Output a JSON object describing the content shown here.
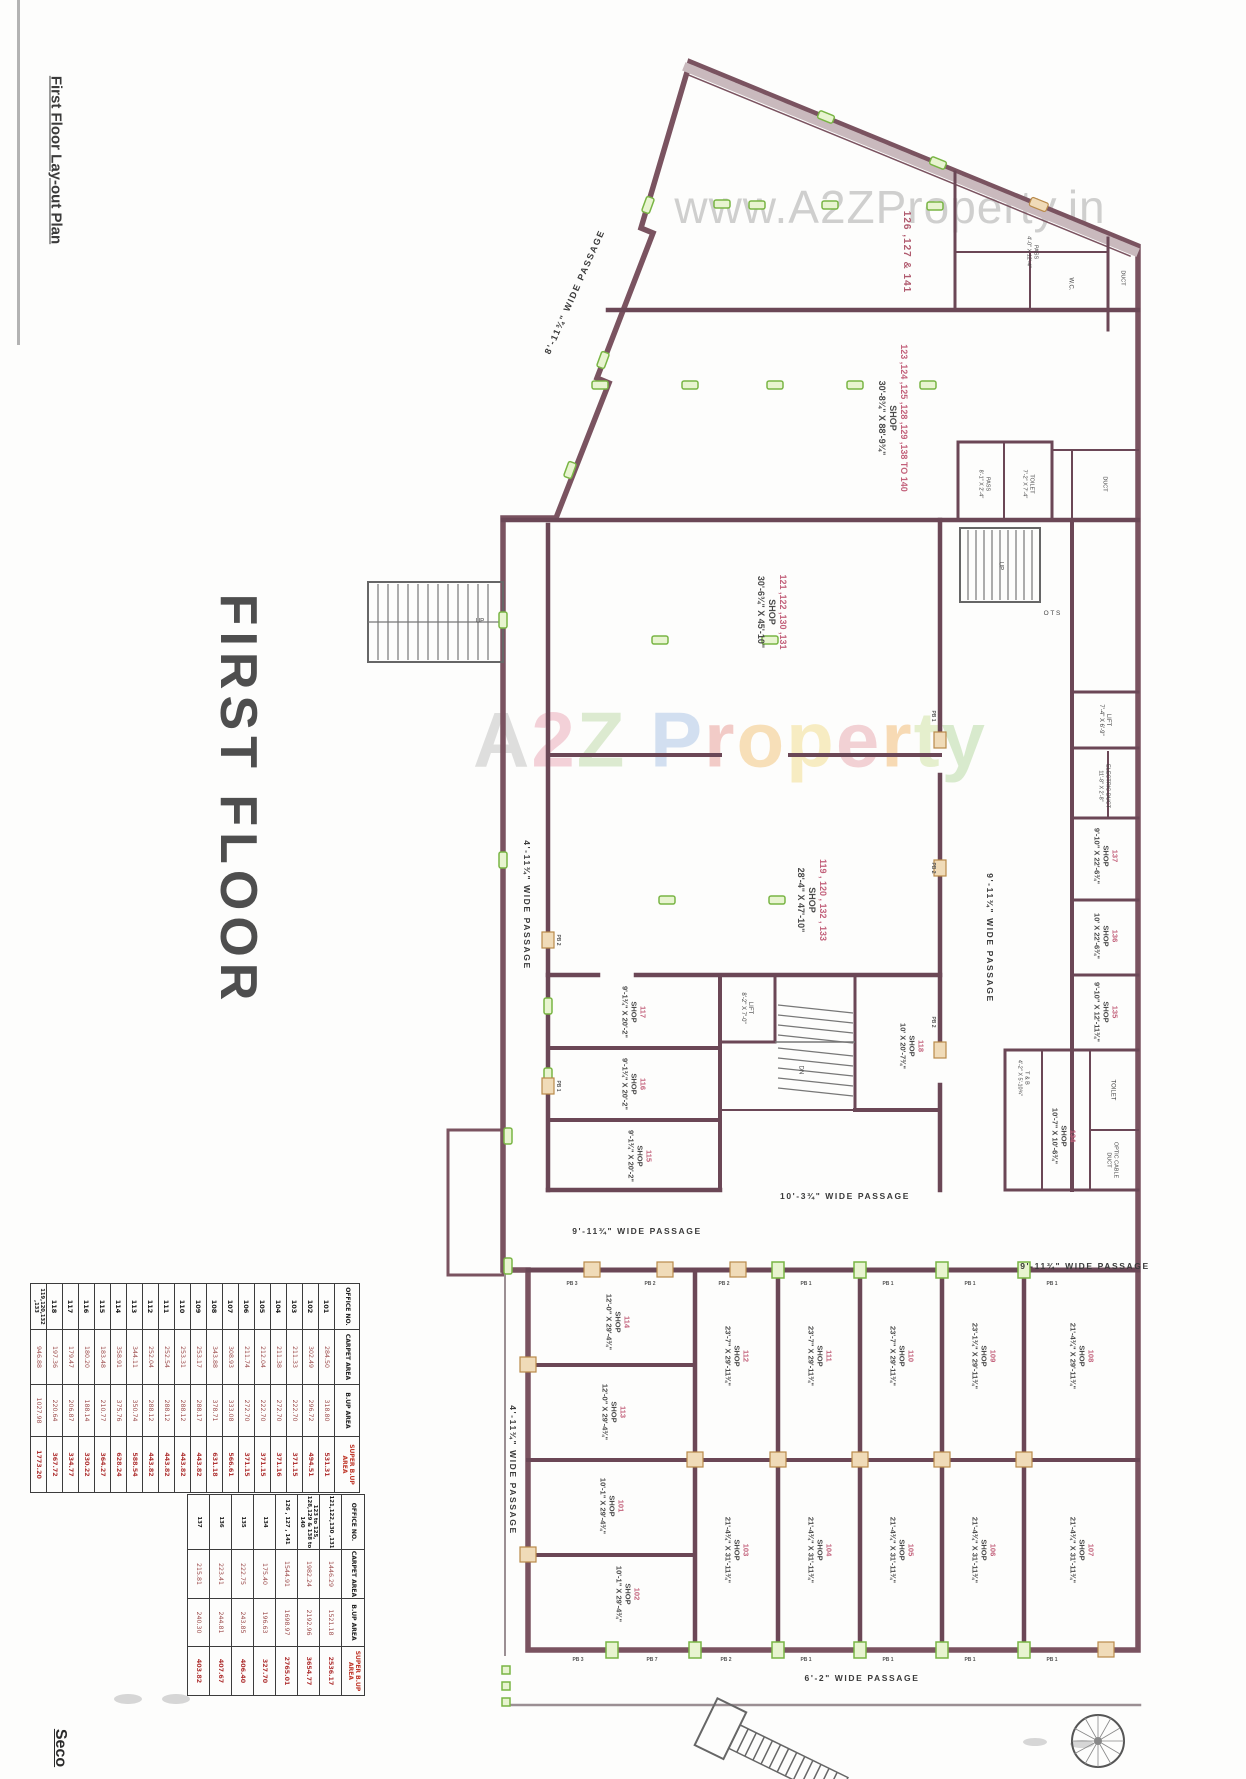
{
  "page": {
    "sheet_title": "First Floor Lay-out Plan",
    "floor_title": "FIRST FLOOR",
    "next_sheet_partial": "Seco",
    "watermark_top": "www.A2ZProperty.in",
    "watermark_center_letters": [
      {
        "ch": "A",
        "color": "#c0c0c0"
      },
      {
        "ch": "2",
        "color": "#eaa6b5"
      },
      {
        "ch": "Z",
        "color": "#bcd9a6"
      },
      {
        "ch": " ",
        "color": "#c0c0c0"
      },
      {
        "ch": "P",
        "color": "#a9c3e6"
      },
      {
        "ch": "r",
        "color": "#e99a93"
      },
      {
        "ch": "o",
        "color": "#f2c277"
      },
      {
        "ch": "p",
        "color": "#f2dd8a"
      },
      {
        "ch": "e",
        "color": "#e9a6ae"
      },
      {
        "ch": "r",
        "color": "#f2b96f"
      },
      {
        "ch": "t",
        "color": "#cfe3a0"
      },
      {
        "ch": "y",
        "color": "#b5d9a0"
      }
    ]
  },
  "colors": {
    "outer_wall": "#7a5360",
    "partition": "#6b4756",
    "marker_green": "#79b544",
    "marker_tan": "#b98a4a",
    "room_number": "#c2607a",
    "table_red": "#c0392b"
  },
  "tables": {
    "headers": [
      "OFFICE NO.",
      "CARPET AREA",
      "B.UP AREA",
      "SUPER B.UP AREA"
    ],
    "first": [
      {
        "no": "101",
        "carpet": "284.50",
        "bup": "318.80",
        "super": "531.31"
      },
      {
        "no": "102",
        "carpet": "302.49",
        "bup": "296.72",
        "super": "494.51"
      },
      {
        "no": "103",
        "carpet": "211.33",
        "bup": "222.70",
        "super": "371.15"
      },
      {
        "no": "104",
        "carpet": "211.38",
        "bup": "272.70",
        "super": "371.16"
      },
      {
        "no": "105",
        "carpet": "212.04",
        "bup": "222.70",
        "super": "371.15"
      },
      {
        "no": "106",
        "carpet": "211.74",
        "bup": "272.70",
        "super": "371.15"
      },
      {
        "no": "107",
        "carpet": "308.93",
        "bup": "333.08",
        "super": "566.61"
      },
      {
        "no": "108",
        "carpet": "343.88",
        "bup": "378.71",
        "super": "631.18"
      },
      {
        "no": "109",
        "carpet": "253.17",
        "bup": "288.17",
        "super": "443.82"
      },
      {
        "no": "110",
        "carpet": "253.31",
        "bup": "288.12",
        "super": "443.82"
      },
      {
        "no": "111",
        "carpet": "252.54",
        "bup": "288.12",
        "super": "443.82"
      },
      {
        "no": "112",
        "carpet": "252.04",
        "bup": "288.12",
        "super": "443.82"
      },
      {
        "no": "113",
        "carpet": "344.11",
        "bup": "350.74",
        "super": "588.54"
      },
      {
        "no": "114",
        "carpet": "358.91",
        "bup": "375.76",
        "super": "628.24"
      },
      {
        "no": "115",
        "carpet": "183.48",
        "bup": "210.77",
        "super": "364.27"
      },
      {
        "no": "116",
        "carpet": "180.20",
        "bup": "188.14",
        "super": "330.22"
      },
      {
        "no": "117",
        "carpet": "179.47",
        "bup": "206.87",
        "super": "334.77"
      },
      {
        "no": "118",
        "carpet": "197.36",
        "bup": "220.64",
        "super": "367.72"
      },
      {
        "no": "119,120,132 ,133",
        "carpet": "946.88",
        "bup": "1027.98",
        "super": "1773.20"
      }
    ],
    "second": [
      {
        "no": "121,122,130 ,131",
        "carpet": "1446.29",
        "bup": "1521.18",
        "super": "2536.17"
      },
      {
        "no": "123 to 125, 128,129 & 138 to 140",
        "carpet": "1982.24",
        "bup": "2192.96",
        "super": "3654.77"
      },
      {
        "no": "126 , 127 , 141",
        "carpet": "1544.91",
        "bup": "1698.97",
        "super": "2765.01"
      },
      {
        "no": "134",
        "carpet": "175.40",
        "bup": "196.63",
        "super": "327.70"
      },
      {
        "no": "135",
        "carpet": "222.75",
        "bup": "243.85",
        "super": "406.40"
      },
      {
        "no": "136",
        "carpet": "223.41",
        "bup": "244.81",
        "super": "407.67"
      },
      {
        "no": "137",
        "carpet": "215.81",
        "bup": "240.30",
        "super": "403.82"
      }
    ]
  },
  "plan": {
    "labels": [
      {
        "name": "room-126-127-141",
        "text": "126 ,127 & 141",
        "x": 906,
        "y": 252,
        "rot": 90,
        "size": 10,
        "cls": "plan-label grp-label"
      },
      {
        "name": "room-123-to-140",
        "text": "123 ,124 ,125 ,128 ,129 ,138 TO 140\nSHOP\n30'-8¾\" X 88'-9¾\"",
        "x": 893,
        "y": 418,
        "rot": 90,
        "size": 9,
        "cls": "plan-label room-label"
      },
      {
        "name": "room-121-122-130-131",
        "text": "121 ,122 ,130 ,131\nSHOP\n30'-6¾\" X 45'-10\"",
        "x": 772,
        "y": 612,
        "rot": 90,
        "size": 9,
        "cls": "plan-label room-label"
      },
      {
        "name": "room-119-120-132-133",
        "text": "119 , 120 , 132 , 133\nSHOP\n28'-4\" X 47'-10\"",
        "x": 812,
        "y": 900,
        "rot": 90,
        "size": 9,
        "cls": "plan-label room-label"
      },
      {
        "name": "room-118",
        "text": "118\nSHOP\n10' X 20'-7¾\"",
        "x": 912,
        "y": 1046,
        "rot": 90,
        "size": 7.5,
        "cls": "plan-label room-label"
      },
      {
        "name": "room-117",
        "text": "117\nSHOP\n9'-1¾\" X 20'-2\"",
        "x": 634,
        "y": 1012,
        "rot": 90,
        "size": 7.5,
        "cls": "plan-label room-label"
      },
      {
        "name": "room-116",
        "text": "116\nSHOP\n9'-1¾\" X 20'-2\"",
        "x": 634,
        "y": 1084,
        "rot": 90,
        "size": 7.5,
        "cls": "plan-label room-label"
      },
      {
        "name": "room-115",
        "text": "115\nSHOP\n9'-1¾\" X 20'-2\"",
        "x": 640,
        "y": 1156,
        "rot": 90,
        "size": 7.5,
        "cls": "plan-label room-label"
      },
      {
        "name": "room-137",
        "text": "137\nSHOP\n9'-10\" X 22'-6¾\"",
        "x": 1106,
        "y": 856,
        "rot": 90,
        "size": 7.5,
        "cls": "plan-label room-label"
      },
      {
        "name": "room-136",
        "text": "136\nSHOP\n10' X 22'-6¾\"",
        "x": 1106,
        "y": 936,
        "rot": 90,
        "size": 7.5,
        "cls": "plan-label room-label"
      },
      {
        "name": "room-135",
        "text": "135\nSHOP\n9'-10\" X 12'-11¾\"",
        "x": 1106,
        "y": 1012,
        "rot": 90,
        "size": 7.5,
        "cls": "plan-label room-label"
      },
      {
        "name": "room-134",
        "text": "134\nSHOP\n10'-7\" X 10'-6¾\"",
        "x": 1064,
        "y": 1136,
        "rot": 90,
        "size": 7.5,
        "cls": "plan-label room-label"
      },
      {
        "name": "lift-right-label",
        "text": "LIFT\n7'-4\" X 6'-9\"",
        "x": 1104,
        "y": 720,
        "rot": 90,
        "size": 6,
        "cls": "plan-label small-label"
      },
      {
        "name": "electric-duct-label",
        "text": "ELECTRIC DUCT\n11'-8\" X 2'-8\"",
        "x": 1104,
        "y": 786,
        "rot": 90,
        "size": 5.5,
        "cls": "plan-label small-label"
      },
      {
        "name": "lift-mid-label",
        "text": "LIFT\n8'-2\" X 7'-0\"",
        "x": 746,
        "y": 1008,
        "rot": 90,
        "size": 6,
        "cls": "plan-label small-label"
      },
      {
        "name": "toilet-right-label",
        "text": "TOILET",
        "x": 1112,
        "y": 1090,
        "rot": 90,
        "size": 6,
        "cls": "plan-label small-label"
      },
      {
        "name": "t-and-b-label",
        "text": "T & B\n4'-2\" X 5'-10¾\"",
        "x": 1023,
        "y": 1078,
        "rot": 90,
        "size": 5.5,
        "cls": "plan-label small-label"
      },
      {
        "name": "optic-cable-duct-label",
        "text": "OPTIC CABLE\nDUCT",
        "x": 1112,
        "y": 1160,
        "rot": 90,
        "size": 5.5,
        "cls": "plan-label small-label"
      },
      {
        "name": "ots-label",
        "text": "O T S",
        "x": 1052,
        "y": 614,
        "rot": 0,
        "size": 6.5,
        "cls": "plan-label small-label"
      },
      {
        "name": "up-stair-right-label",
        "text": "UP",
        "x": 1000,
        "y": 566,
        "rot": 90,
        "size": 6,
        "cls": "plan-label small-label"
      },
      {
        "name": "dn-stair-mid-label",
        "text": "DN",
        "x": 800,
        "y": 1070,
        "rot": 90,
        "size": 6,
        "cls": "plan-label small-label"
      },
      {
        "name": "up-stair-left-label",
        "text": "UP",
        "x": 480,
        "y": 622,
        "rot": 0,
        "size": 6,
        "cls": "plan-label small-label"
      },
      {
        "name": "pass-top-label",
        "text": "PASS\n4'-0\" X 12'-4\"",
        "x": 1032,
        "y": 252,
        "rot": 90,
        "size": 5.5,
        "cls": "plan-label small-label"
      },
      {
        "name": "wc-top-label",
        "text": "W.C.",
        "x": 1070,
        "y": 284,
        "rot": 90,
        "size": 6,
        "cls": "plan-label small-label"
      },
      {
        "name": "duct-top-label",
        "text": "DUCT",
        "x": 1122,
        "y": 278,
        "rot": 90,
        "size": 5.5,
        "cls": "plan-label small-label"
      },
      {
        "name": "pass-mid-label",
        "text": "PASS\n8'-1\" X 2'-4\"",
        "x": 984,
        "y": 484,
        "rot": 90,
        "size": 5.5,
        "cls": "plan-label small-label"
      },
      {
        "name": "toilet-mid-label",
        "text": "TOILET\n7'-2\" X 7'-4\"",
        "x": 1028,
        "y": 484,
        "rot": 90,
        "size": 5.5,
        "cls": "plan-label small-label"
      },
      {
        "name": "duct-mid-label",
        "text": "DUCT",
        "x": 1104,
        "y": 484,
        "rot": 90,
        "size": 5.5,
        "cls": "plan-label small-label"
      },
      {
        "name": "passage-diagonal-label",
        "text": "8'-11¾\" WIDE PASSAGE",
        "x": 575,
        "y": 292,
        "rot": -66,
        "size": 9,
        "cls": "plan-label passage-label"
      },
      {
        "name": "passage-left-upper-label",
        "text": "4'-11¾\" WIDE PASSAGE",
        "x": 527,
        "y": 905,
        "rot": 90,
        "size": 8.5,
        "cls": "plan-label passage-label"
      },
      {
        "name": "passage-left-lower-label",
        "text": "4'-11¾\" WIDE PASSAGE",
        "x": 513,
        "y": 1470,
        "rot": 90,
        "size": 8.5,
        "cls": "plan-label passage-label"
      },
      {
        "name": "passage-mid-vertical-label",
        "text": "9'-11¾\" WIDE PASSAGE",
        "x": 990,
        "y": 938,
        "rot": 90,
        "size": 8.5,
        "cls": "plan-label passage-label"
      },
      {
        "name": "passage-h-left-label",
        "text": "9'-11¾\" WIDE PASSAGE",
        "x": 637,
        "y": 1231,
        "rot": 0,
        "size": 8.5,
        "cls": "plan-label passage-label"
      },
      {
        "name": "passage-h-mid-label",
        "text": "10'-3¾\" WIDE PASSAGE",
        "x": 845,
        "y": 1196,
        "rot": 0,
        "size": 8.5,
        "cls": "plan-label passage-label"
      },
      {
        "name": "passage-h-right-label",
        "text": "9'-11¾\" WIDE PASSAGE",
        "x": 1085,
        "y": 1266,
        "rot": 0,
        "size": 8.5,
        "cls": "plan-label passage-label"
      },
      {
        "name": "passage-h-bottom-label",
        "text": "6'-2\" WIDE PASSAGE",
        "x": 862,
        "y": 1678,
        "rot": 0,
        "size": 8.5,
        "cls": "plan-label passage-label"
      },
      {
        "name": "room-114",
        "text": "114\nSHOP\n12'-0\" X 29'-4¾\"",
        "x": 618,
        "y": 1322,
        "rot": 90,
        "size": 7.5,
        "cls": "plan-label room-label"
      },
      {
        "name": "room-113",
        "text": "113\nSHOP\n12'-0\" X 29'-4¾\"",
        "x": 614,
        "y": 1412,
        "rot": 90,
        "size": 7.5,
        "cls": "plan-label room-label"
      },
      {
        "name": "room-101",
        "text": "101\nSHOP\n10'-1\" X 29'-4¾\"",
        "x": 612,
        "y": 1506,
        "rot": 90,
        "size": 7.5,
        "cls": "plan-label room-label"
      },
      {
        "name": "room-102",
        "text": "102\nSHOP\n10'-1\" X 29'-4¾\"",
        "x": 628,
        "y": 1594,
        "rot": 90,
        "size": 7.5,
        "cls": "plan-label room-label"
      },
      {
        "name": "room-112",
        "text": "112\nSHOP\n23'-7\" X 29'-11¾\"",
        "x": 737,
        "y": 1356,
        "rot": 90,
        "size": 7.5,
        "cls": "plan-label room-label"
      },
      {
        "name": "room-111",
        "text": "111\nSHOP\n23'-7\" X 29'-11¾\"",
        "x": 820,
        "y": 1356,
        "rot": 90,
        "size": 7.5,
        "cls": "plan-label room-label"
      },
      {
        "name": "room-110",
        "text": "110\nSHOP\n23'-7\" X 29'-11¾\"",
        "x": 902,
        "y": 1356,
        "rot": 90,
        "size": 7.5,
        "cls": "plan-label room-label"
      },
      {
        "name": "room-109",
        "text": "109\nSHOP\n23'-1¾\" X 29'-11¾\"",
        "x": 984,
        "y": 1356,
        "rot": 90,
        "size": 7.5,
        "cls": "plan-label room-label"
      },
      {
        "name": "room-108",
        "text": "108\nSHOP\n21'-4¾\" X 29'-11¾\"",
        "x": 1082,
        "y": 1356,
        "rot": 90,
        "size": 7.5,
        "cls": "plan-label room-label"
      },
      {
        "name": "room-103",
        "text": "103\nSHOP\n21'-4¾\" X 31'-11¾\"",
        "x": 737,
        "y": 1550,
        "rot": 90,
        "size": 7.5,
        "cls": "plan-label room-label"
      },
      {
        "name": "room-104",
        "text": "104\nSHOP\n21'-4¾\" X 31'-11¾\"",
        "x": 820,
        "y": 1550,
        "rot": 90,
        "size": 7.5,
        "cls": "plan-label room-label"
      },
      {
        "name": "room-105",
        "text": "105\nSHOP\n21'-4¾\" X 31'-11¾\"",
        "x": 902,
        "y": 1550,
        "rot": 90,
        "size": 7.5,
        "cls": "plan-label room-label"
      },
      {
        "name": "room-106",
        "text": "106\nSHOP\n21'-4¾\" X 31'-11¾\"",
        "x": 984,
        "y": 1550,
        "rot": 90,
        "size": 7.5,
        "cls": "plan-label room-label"
      },
      {
        "name": "room-107",
        "text": "107\nSHOP\n21'-4¾\" X 31'-11¾\"",
        "x": 1082,
        "y": 1550,
        "rot": 90,
        "size": 7.5,
        "cls": "plan-label room-label"
      },
      {
        "name": "pier-label",
        "text": "PB 3",
        "x": 572,
        "y": 1284,
        "rot": 0,
        "size": 5,
        "cls": "plan-label tiny"
      },
      {
        "name": "pier-label",
        "text": "PB 2",
        "x": 650,
        "y": 1284,
        "rot": 0,
        "size": 5,
        "cls": "plan-label tiny"
      },
      {
        "name": "pier-label",
        "text": "PB 2",
        "x": 724,
        "y": 1284,
        "rot": 0,
        "size": 5,
        "cls": "plan-label tiny"
      },
      {
        "name": "pier-label",
        "text": "PB 1",
        "x": 806,
        "y": 1284,
        "rot": 0,
        "size": 5,
        "cls": "plan-label tiny"
      },
      {
        "name": "pier-label",
        "text": "PB 1",
        "x": 888,
        "y": 1284,
        "rot": 0,
        "size": 5,
        "cls": "plan-label tiny"
      },
      {
        "name": "pier-label",
        "text": "PB 1",
        "x": 970,
        "y": 1284,
        "rot": 0,
        "size": 5,
        "cls": "plan-label tiny"
      },
      {
        "name": "pier-label",
        "text": "PB 1",
        "x": 1052,
        "y": 1284,
        "rot": 0,
        "size": 5,
        "cls": "plan-label tiny"
      },
      {
        "name": "pier-label",
        "text": "PB 3",
        "x": 578,
        "y": 1660,
        "rot": 0,
        "size": 5,
        "cls": "plan-label tiny"
      },
      {
        "name": "pier-label",
        "text": "PB 7",
        "x": 652,
        "y": 1660,
        "rot": 0,
        "size": 5,
        "cls": "plan-label tiny"
      },
      {
        "name": "pier-label",
        "text": "PB 2",
        "x": 726,
        "y": 1660,
        "rot": 0,
        "size": 5,
        "cls": "plan-label tiny"
      },
      {
        "name": "pier-label",
        "text": "PB 1",
        "x": 806,
        "y": 1660,
        "rot": 0,
        "size": 5,
        "cls": "plan-label tiny"
      },
      {
        "name": "pier-label",
        "text": "PB 1",
        "x": 888,
        "y": 1660,
        "rot": 0,
        "size": 5,
        "cls": "plan-label tiny"
      },
      {
        "name": "pier-label",
        "text": "PB 1",
        "x": 970,
        "y": 1660,
        "rot": 0,
        "size": 5,
        "cls": "plan-label tiny"
      },
      {
        "name": "pier-label",
        "text": "PB 1",
        "x": 1052,
        "y": 1660,
        "rot": 0,
        "size": 5,
        "cls": "plan-label tiny"
      },
      {
        "name": "pier-label",
        "text": "PB 1",
        "x": 933,
        "y": 716,
        "rot": 90,
        "size": 5,
        "cls": "plan-label tiny"
      },
      {
        "name": "pier-label",
        "text": "PB 2",
        "x": 933,
        "y": 868,
        "rot": 90,
        "size": 5,
        "cls": "plan-label tiny"
      },
      {
        "name": "pier-label",
        "text": "PB 2",
        "x": 933,
        "y": 1022,
        "rot": 90,
        "size": 5,
        "cls": "plan-label tiny"
      },
      {
        "name": "pier-label",
        "text": "PB 2",
        "x": 558,
        "y": 940,
        "rot": 90,
        "size": 5,
        "cls": "plan-label tiny"
      },
      {
        "name": "pier-label",
        "text": "PB 1",
        "x": 558,
        "y": 1086,
        "rot": 90,
        "size": 5,
        "cls": "plan-label tiny"
      }
    ]
  }
}
